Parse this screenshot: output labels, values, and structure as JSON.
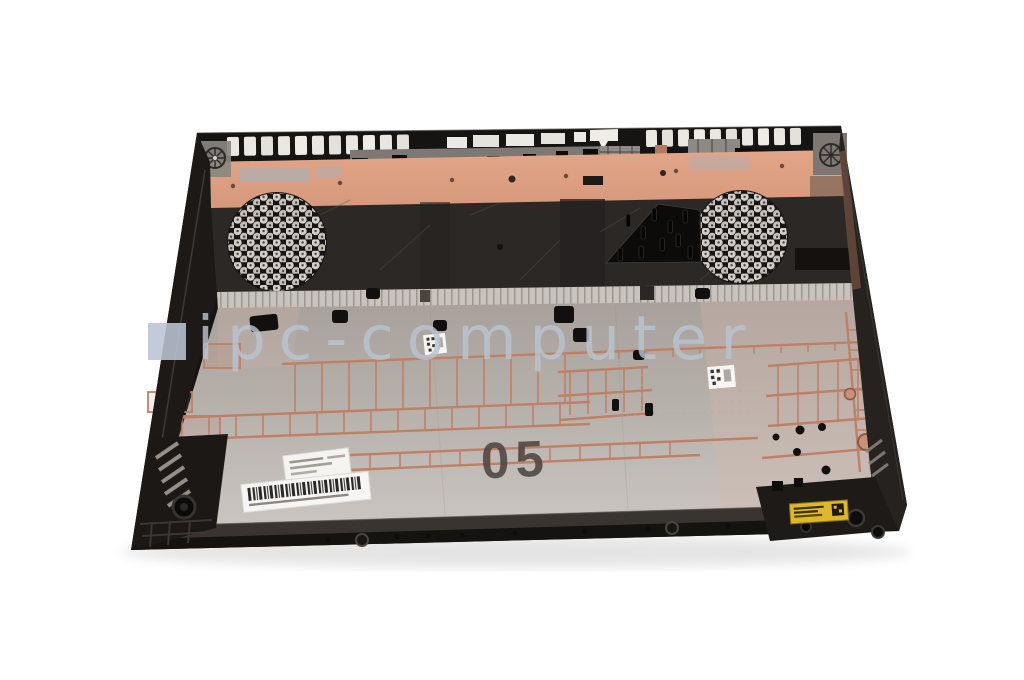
{
  "photo": {
    "background_color": "#ffffff",
    "subject": "Laptop bottom case (lower cover), inside view: black outer rim with vent slots, copper heatsink strip, black panel with two honeycomb speaker grilles and fan mount, silver chassis body with copper reinforcement ribs, service labels and barcode",
    "mold_marking": "05",
    "watermark": {
      "text": "ipc-computer",
      "color": "#b9c4d1"
    },
    "colors": {
      "copper_strip": "#dda083",
      "copper_rib": "#c08066",
      "chassis_silver": "#b6b0ab",
      "panel_black": "#2b2826",
      "rim_black": "#161412",
      "grille_dot": "#d6d0ca",
      "label_white": "#f7f6f4",
      "sticker_yellow": "#ddb92a",
      "marking_color": "#4a423c"
    }
  }
}
